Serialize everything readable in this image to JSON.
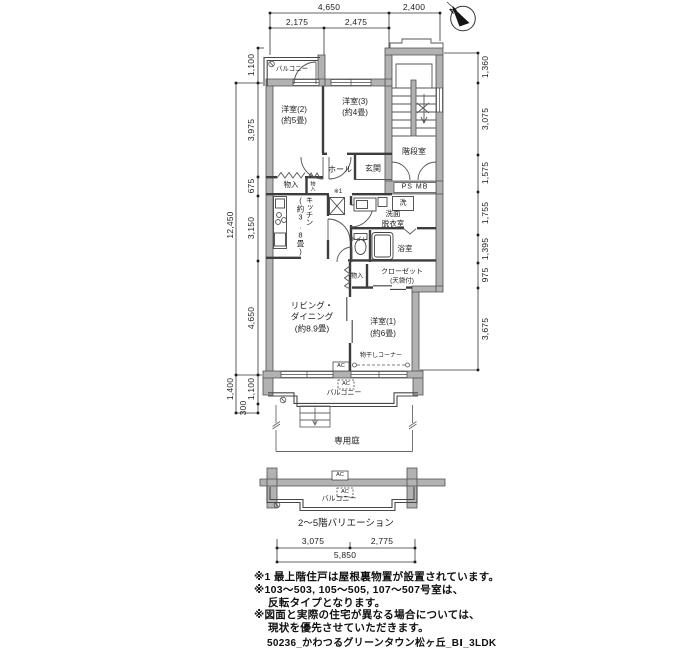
{
  "meta": {
    "caption": "50236_かわつるグリーンタウン松ヶ丘_BⅠ_3LDK",
    "variation_label": "2〜5階バリエーション"
  },
  "compass": {
    "label": "N"
  },
  "rooms": {
    "balcony": "バルコニー",
    "yoshitsu2": "洋室(2)",
    "yoshitsu2_size": "(約5畳)",
    "yoshitsu3": "洋室(3)",
    "yoshitsu3_size": "(約4畳)",
    "yoshitsu1": "洋室(1)",
    "yoshitsu1_size": "(約6畳)",
    "kaidan": "階段室",
    "hall": "ホール",
    "genkan": "玄関",
    "monoiri": "物入",
    "ps_mb": "PS MB",
    "kitchen": "キッチン",
    "kitchen_size": "(約3.8畳)",
    "senmen": "洗面",
    "datsui": "脱衣室",
    "laundry": "洗",
    "toilet": "トイレ",
    "bath": "浴室",
    "closet": "クローゼット",
    "closet_note": "(天袋付)",
    "living1": "リビング・",
    "living2": "ダイニング",
    "living_size": "(約8.9畳)",
    "monohoshi": "物干しコーナー",
    "garden": "専用庭",
    "ac": "AC",
    "ref1": "※1"
  },
  "dims": {
    "top": {
      "w1": "4,650",
      "w2": "2,400",
      "w3": "2,175",
      "w4": "2,475"
    },
    "left": {
      "total": "12,450",
      "l1": "1,100",
      "l2": "3,975",
      "l3": "675",
      "l4": "3,150",
      "l5": "4,650",
      "l6": "1,400",
      "l7": "1,100",
      "l8": "300"
    },
    "right": {
      "r1": "1,360",
      "r2": "3,075",
      "r3": "1,575",
      "r4": "1,755",
      "r5": "1,395",
      "r6": "975",
      "r7": "3,675"
    },
    "bottom": {
      "b1": "3,075",
      "b2": "2,775",
      "total": "5,850"
    }
  },
  "notes": {
    "line1": "※1 最上階住戸は屋根裏物置が設置されています。",
    "line2": "※103〜503, 105〜505, 107〜507号室は、",
    "line3": "反転タイプとなります。",
    "line4": "※図面と実際の住宅が異なる場合については、",
    "line5": "現状を優先させていただきます。"
  }
}
